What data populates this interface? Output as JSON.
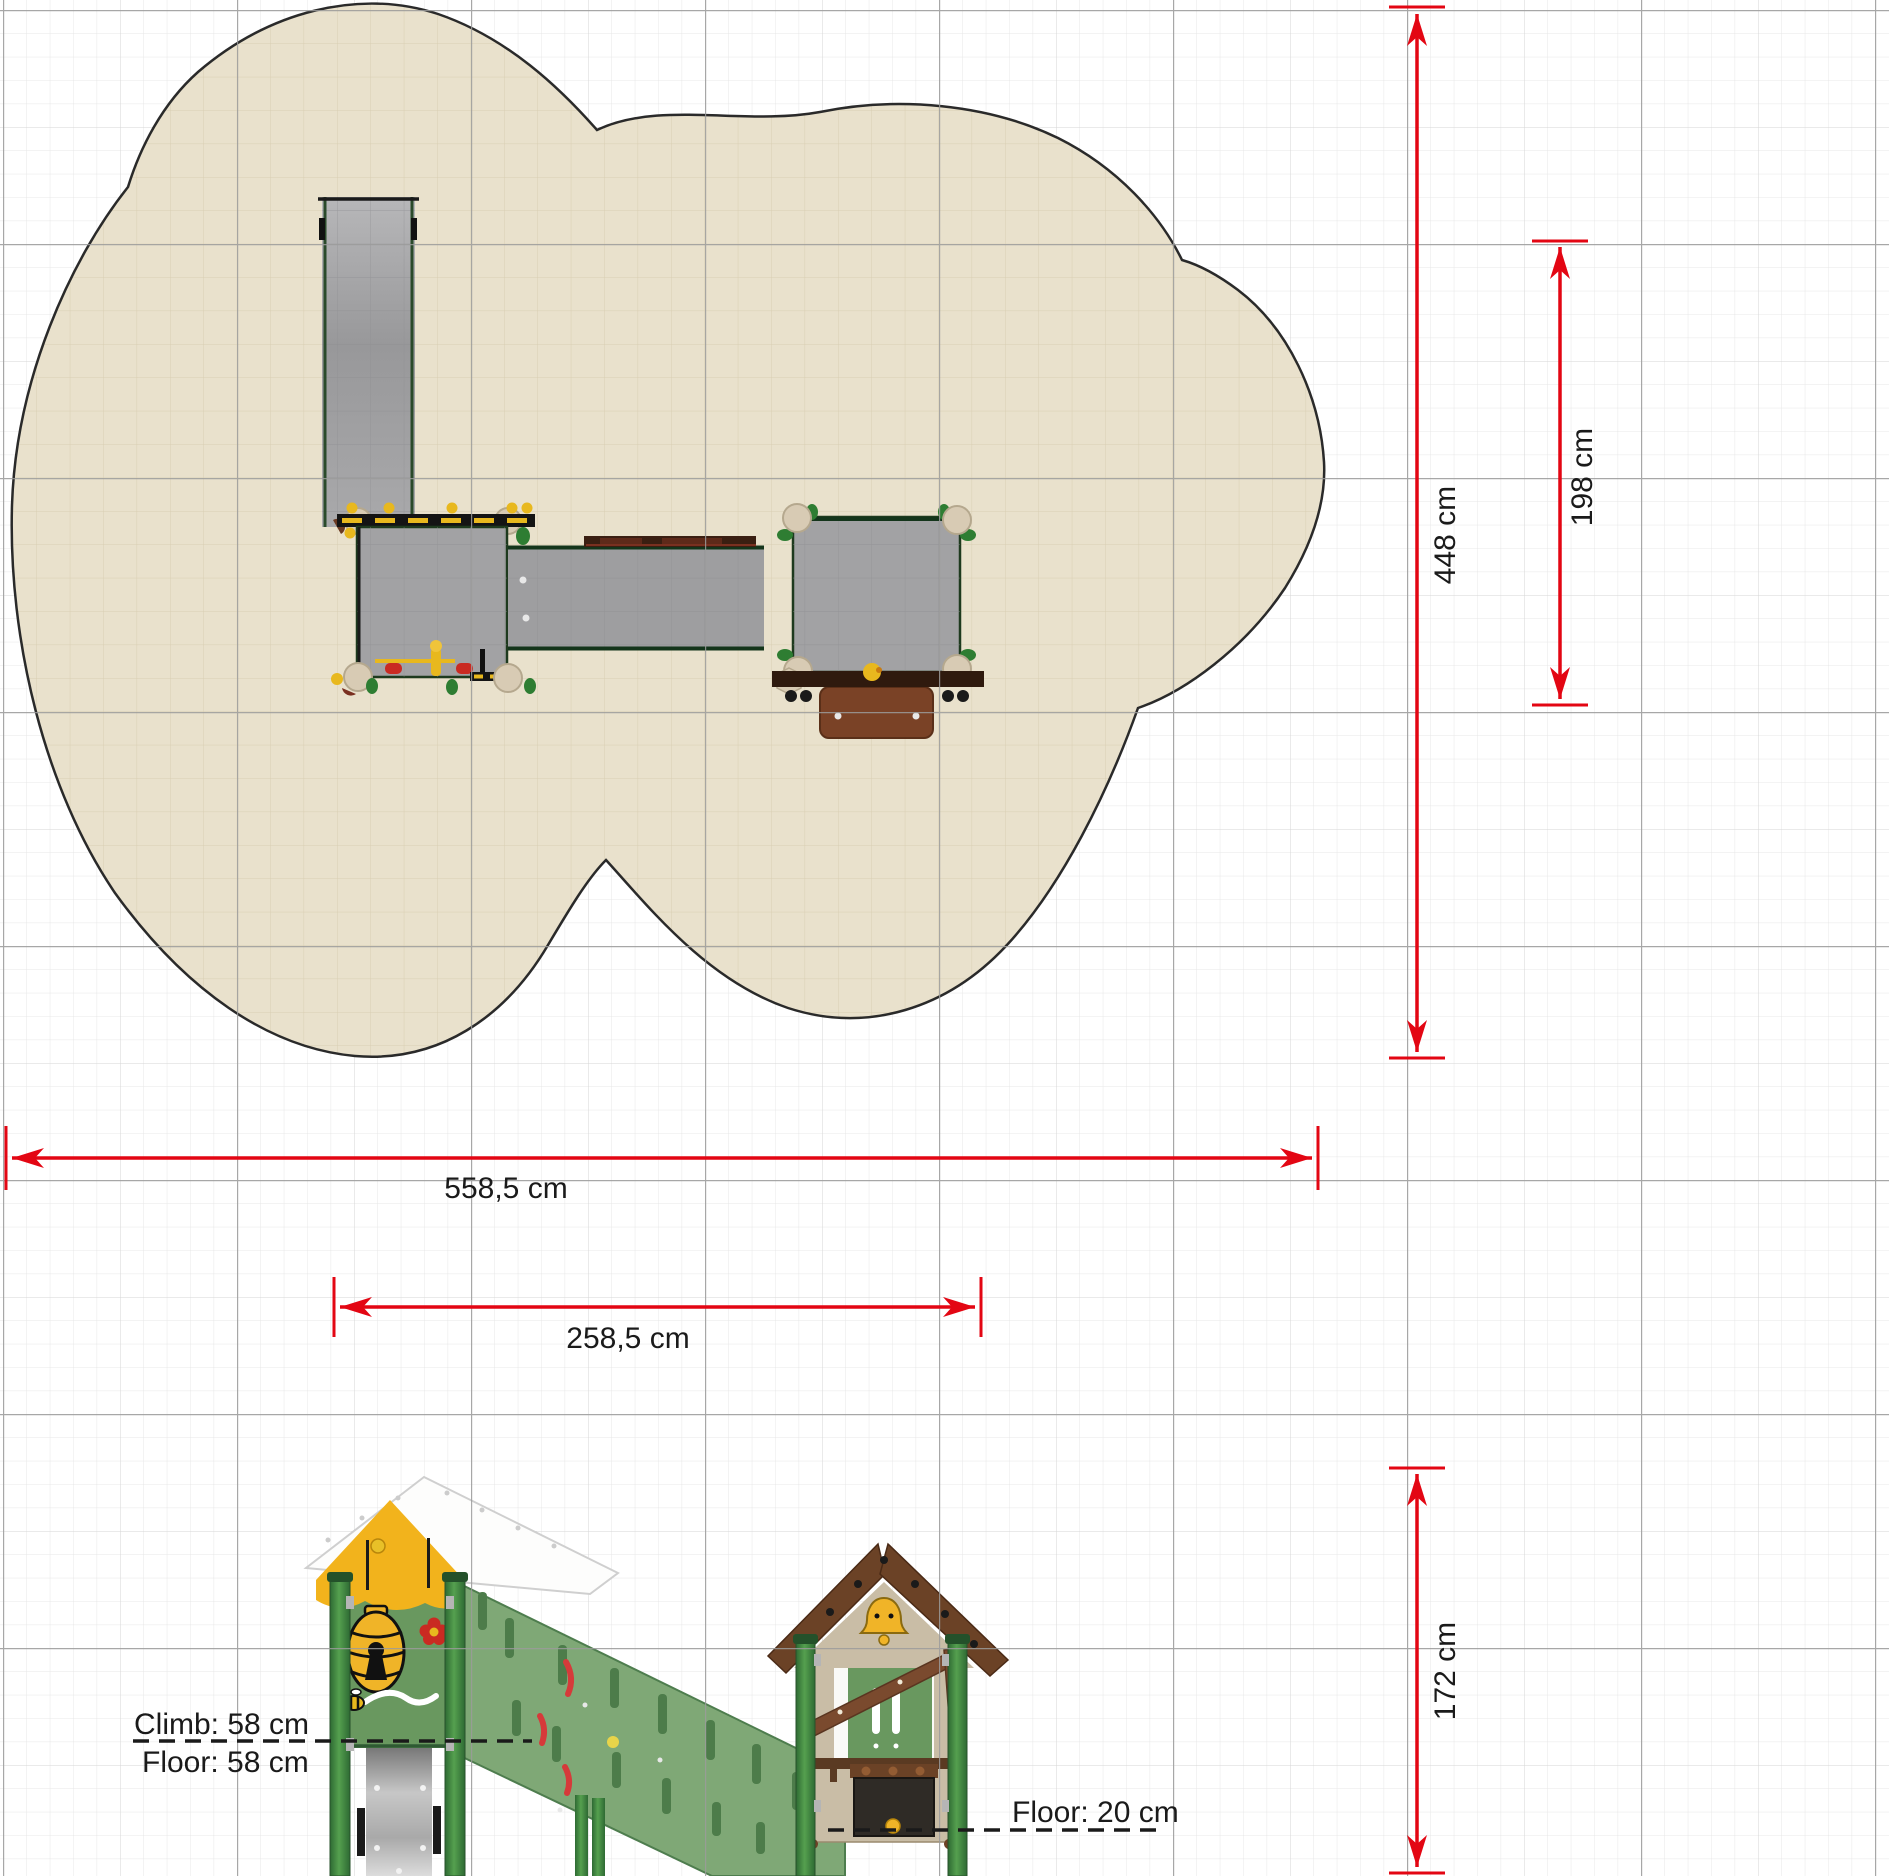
{
  "drawing": {
    "type": "playground-equipment-technical-drawing",
    "views": [
      "top-plan-view",
      "side-elevation-view"
    ]
  },
  "dimensions": {
    "area_width": "558,5 cm",
    "equipment_width": "258,5 cm",
    "area_depth": "448 cm",
    "area_depth_right": "198 cm",
    "equipment_height": "172 cm"
  },
  "annotations": {
    "climb": "Climb: 58 cm",
    "floor_left": "Floor: 58 cm",
    "floor_right": "Floor: 20 cm"
  },
  "colors": {
    "dimension_red": "#e30613",
    "safety_surface_beige": "#e9e1cc",
    "platform_gray": "#a2a2a4",
    "equipment_green": "#69985f",
    "post_green": "#3f8243",
    "roof_yellow": "#f2b31c",
    "roof_brown": "#6b4226",
    "wall_tan": "#c9bda6",
    "grid_major": "#9b9b9b"
  }
}
